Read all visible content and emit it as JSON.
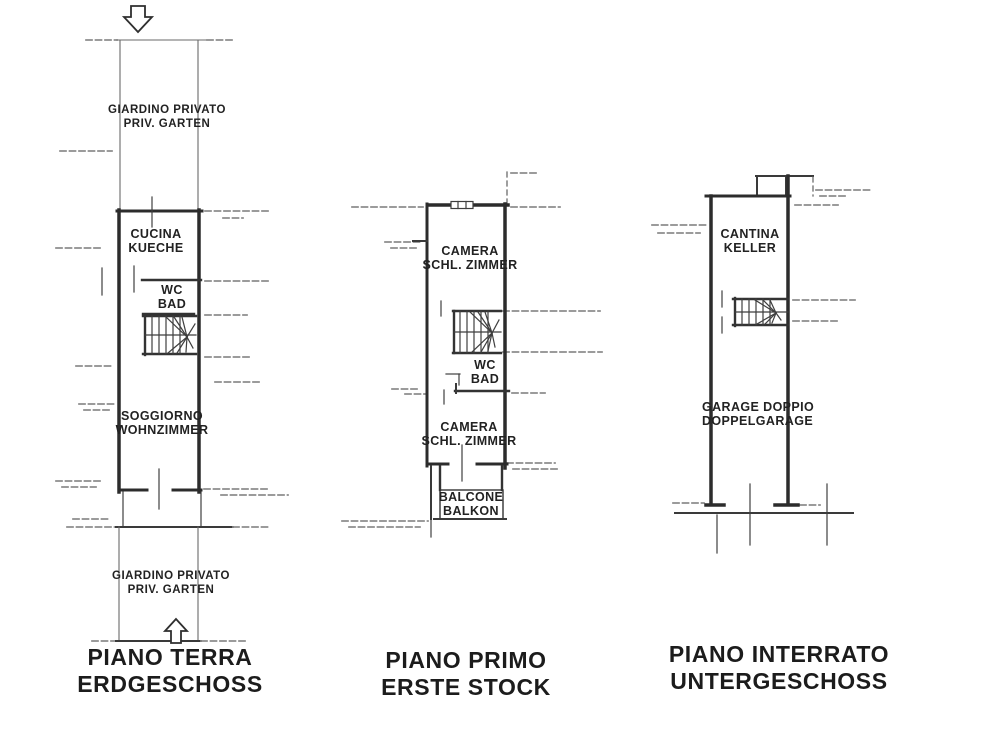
{
  "sheet": {
    "background": "#ffffff",
    "ink": "#2c2c2c",
    "dash_color": "#8d8d8d"
  },
  "plans": [
    {
      "id": "piano-terra",
      "title": {
        "line1": "PIANO TERRA",
        "line2": "ERDGESCHOSS"
      },
      "labels": {
        "garden_top": {
          "line1": "GIARDINO PRIVATO",
          "line2": "PRIV. GARTEN"
        },
        "kitchen": {
          "line1": "CUCINA",
          "line2": "KUECHE"
        },
        "wc": {
          "line1": "WC",
          "line2": "BAD"
        },
        "living": {
          "line1": "SOGGIORNO",
          "line2": "WOHNZIMMER"
        },
        "garden_bottom": {
          "line1": "GIARDINO PRIVATO",
          "line2": "PRIV. GARTEN"
        }
      }
    },
    {
      "id": "piano-primo",
      "title": {
        "line1": "PIANO PRIMO",
        "line2": "ERSTE STOCK"
      },
      "labels": {
        "bedroom_top": {
          "line1": "CAMERA",
          "line2": "SCHL. ZIMMER"
        },
        "wc": {
          "line1": "WC",
          "line2": "BAD"
        },
        "bedroom_bottom": {
          "line1": "CAMERA",
          "line2": "SCHL. ZIMMER"
        },
        "balcony": {
          "line1": "BALCONE",
          "line2": "BALKON"
        }
      }
    },
    {
      "id": "piano-interrato",
      "title": {
        "line1": "PIANO INTERRATO",
        "line2": "UNTERGESCHOSS"
      },
      "labels": {
        "cellar": {
          "line1": "CANTINA",
          "line2": "KELLER"
        },
        "garage": {
          "line1": "GARAGE DOPPIO",
          "line2": "DOPPELGARAGE"
        }
      }
    }
  ]
}
